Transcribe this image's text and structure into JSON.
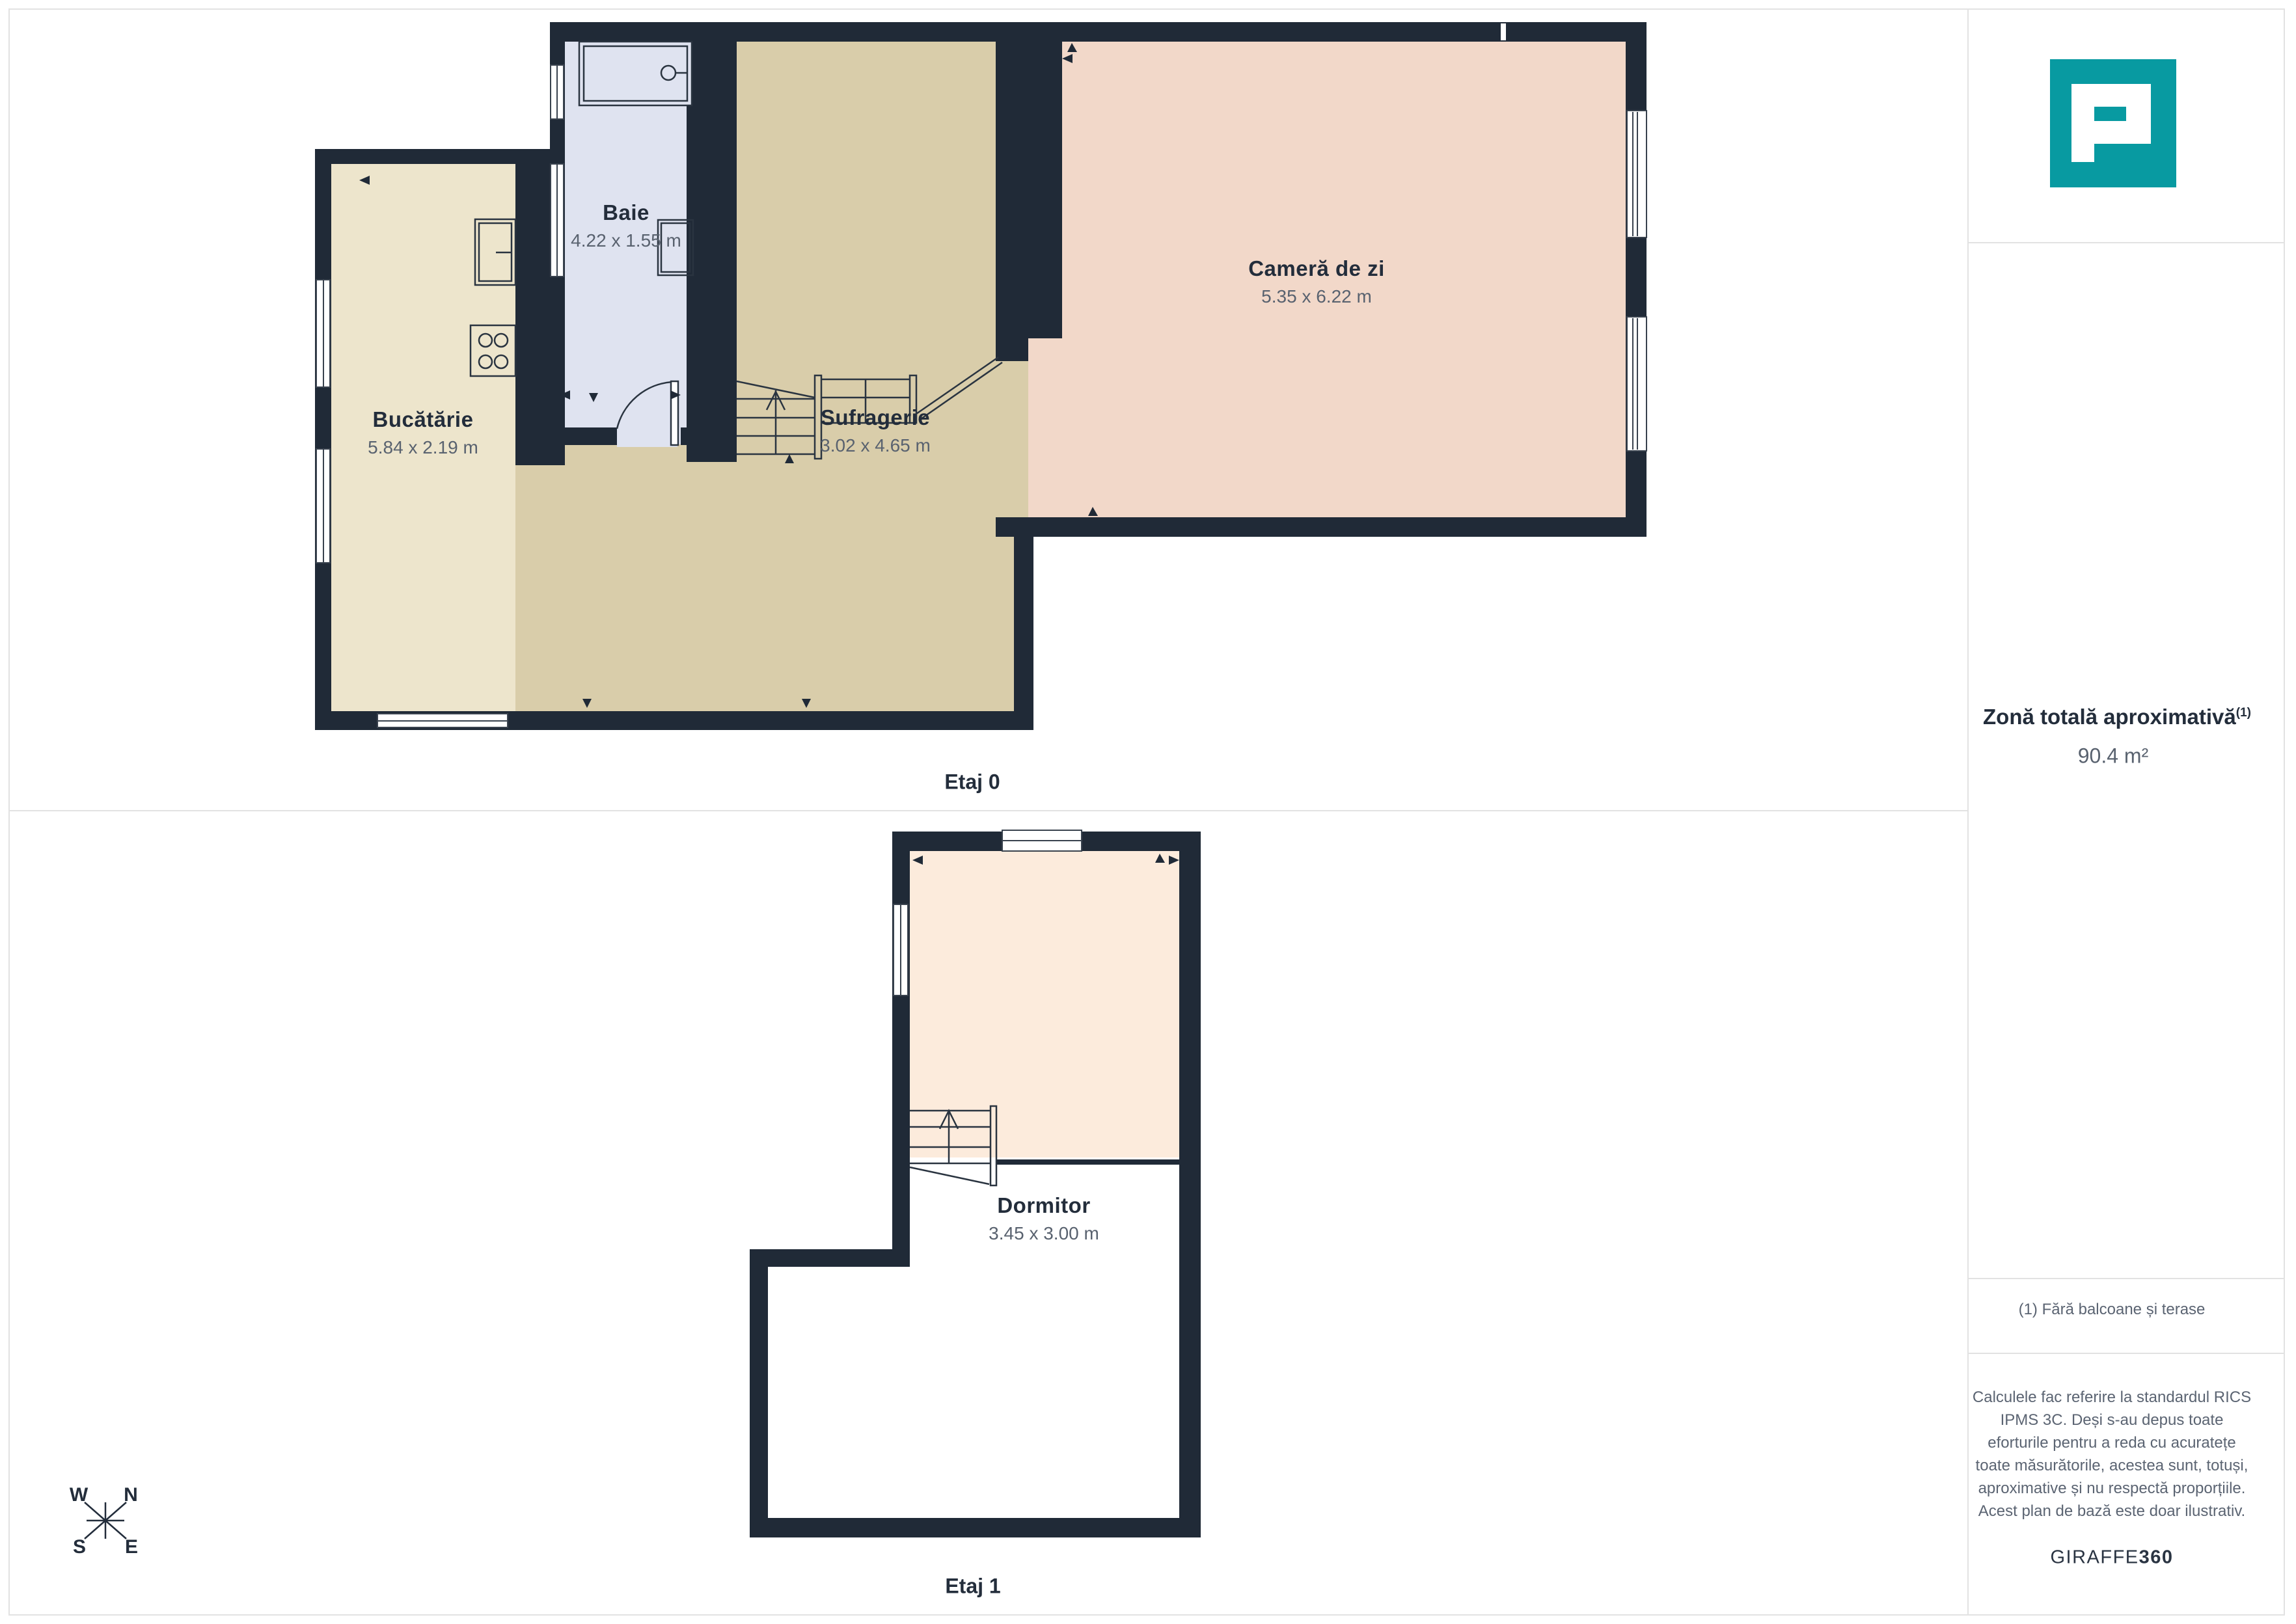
{
  "palette": {
    "wall": "#202a37",
    "kitchen_floor": "#ede5cc",
    "dining_floor": "#d9cdaa",
    "living_floor": "#f2d8c9",
    "bath_floor": "#dfe3f0",
    "bedroom_floor": "#fcebdc",
    "label_dark": "#232d3b",
    "label_grey": "#59626f",
    "divider_grey": "#e2e2e2",
    "brand_teal": "#089aa1"
  },
  "floors": [
    {
      "label": "Etaj 0",
      "rooms": [
        {
          "name": "Bucătărie",
          "dims": "5.84 x 2.19 m"
        },
        {
          "name": "Baie",
          "dims": "4.22 x 1.55 m"
        },
        {
          "name": "Sufragerie",
          "dims": "3.02 x 4.65 m"
        },
        {
          "name": "Cameră de zi",
          "dims": "5.35 x 6.22 m"
        }
      ]
    },
    {
      "label": "Etaj 1",
      "rooms": [
        {
          "name": "Dormitor",
          "dims": "3.45 x 3.00 m"
        }
      ]
    }
  ],
  "compass": {
    "n": "N",
    "e": "E",
    "s": "S",
    "w": "W"
  },
  "sidebar": {
    "total_title": "Zonă totală aproximativă",
    "total_sup": "(1)",
    "total_value": "90.4 m²",
    "footnote": "(1) Fără balcoane și terase",
    "disclaimer": "Calculele fac referire la standardul RICS\nIPMS 3C. Deși s-au depus toate\neforturile pentru a reda cu acuratețe\ntoate măsurătorile, acestea sunt, totuși,\naproximative și nu respectă proporțiile.\nAcest plan de bază este doar ilustrativ.",
    "brand": "GIRAFFE",
    "brand_suffix": "360"
  }
}
